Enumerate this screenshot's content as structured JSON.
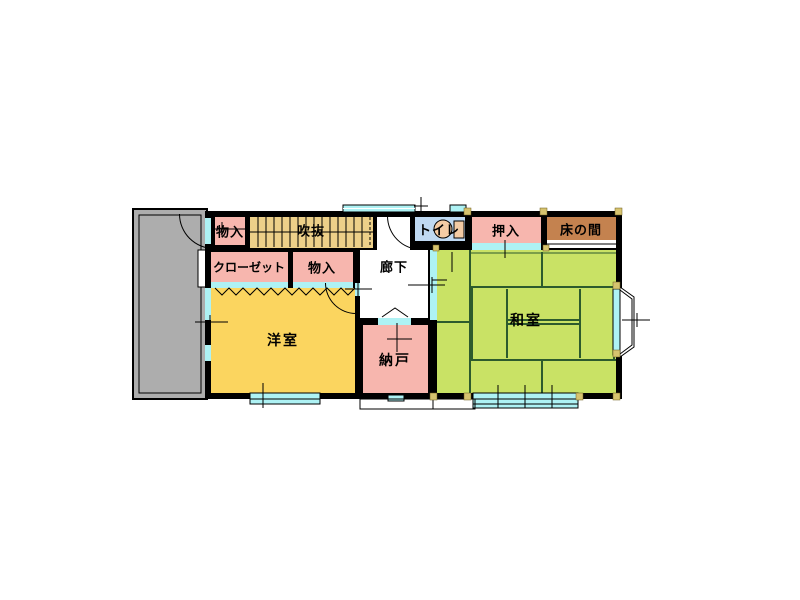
{
  "palette": {
    "wall": "#000000",
    "room_pink": "#F7B6AE",
    "tatami_green": "#C9E265",
    "tatami_line": "#2D5B2D",
    "western_yellow": "#FBD55F",
    "stairs_tan": "#EDD089",
    "tokonoma_brown": "#C4824F",
    "balcony_gray": "#ADADAD",
    "window_cyan": "#AEF2F4",
    "toilet_blue": "#BFD9F2",
    "fixture_peach": "#F4CBA4",
    "pillar_tan": "#D6C36F",
    "paper_white": "#FFFFFF"
  },
  "rooms": [
    {
      "name": "storage-1",
      "label": "物入"
    },
    {
      "name": "stairwell-void",
      "label": "吹抜"
    },
    {
      "name": "toilet",
      "label": "トイレ"
    },
    {
      "name": "oshiire-closet",
      "label": "押入"
    },
    {
      "name": "tokonoma-alcove",
      "label": "床の間"
    },
    {
      "name": "closet",
      "label": "クローゼット"
    },
    {
      "name": "storage-2",
      "label": "物入"
    },
    {
      "name": "hallway",
      "label": "廊下"
    },
    {
      "name": "western-room",
      "label": "洋室"
    },
    {
      "name": "storage-room",
      "label": "納戸"
    },
    {
      "name": "japanese-room",
      "label": "和室"
    }
  ]
}
